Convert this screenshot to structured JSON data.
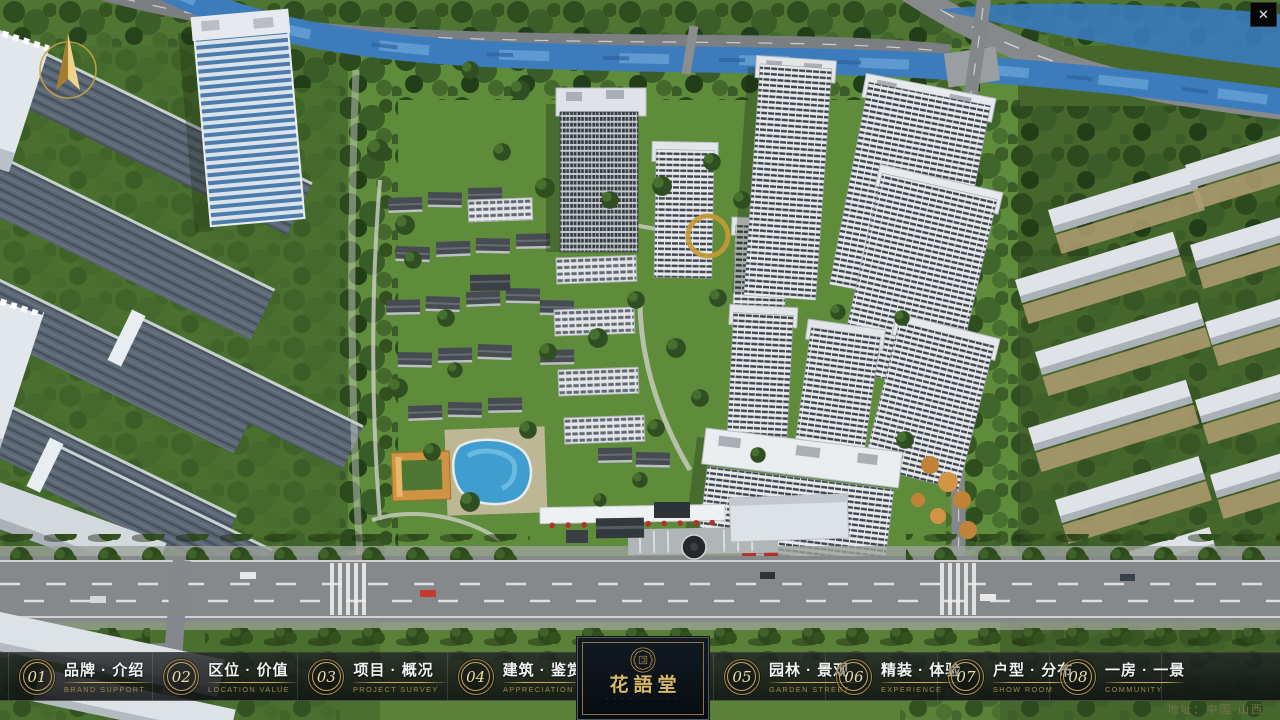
{
  "window": {
    "close_glyph": "✕"
  },
  "nav": {
    "items": [
      {
        "num": "01",
        "zh": "品牌 · 介绍",
        "en": "BRAND SUPPORT"
      },
      {
        "num": "02",
        "zh": "区位 · 价值",
        "en": "LOCATION VALUE"
      },
      {
        "num": "03",
        "zh": "项目 · 概况",
        "en": "PROJECT SURVEY"
      },
      {
        "num": "04",
        "zh": "建筑 · 鉴赏",
        "en": "APPRECIATION"
      },
      {
        "num": "05",
        "zh": "园林 · 景观",
        "en": "GARDEN STREET"
      },
      {
        "num": "06",
        "zh": "精装 · 体验",
        "en": "EXPERIENCE"
      },
      {
        "num": "07",
        "zh": "户型 · 分布",
        "en": "SHOW ROOM"
      },
      {
        "num": "08",
        "zh": "一房 · 一景",
        "en": "COMMUNITY"
      }
    ]
  },
  "logo": {
    "title": "花語堂",
    "caption": "· · · · · · · · · ·"
  },
  "footer": {
    "address": "地址：中国·山西"
  },
  "colors": {
    "accent_gold": "#c8a85c",
    "navbar_bg": "rgba(12,14,16,0.84)",
    "river_blue": "#3c7cbd",
    "lawn_green": "#5a8138",
    "address_text": "#73714e"
  }
}
